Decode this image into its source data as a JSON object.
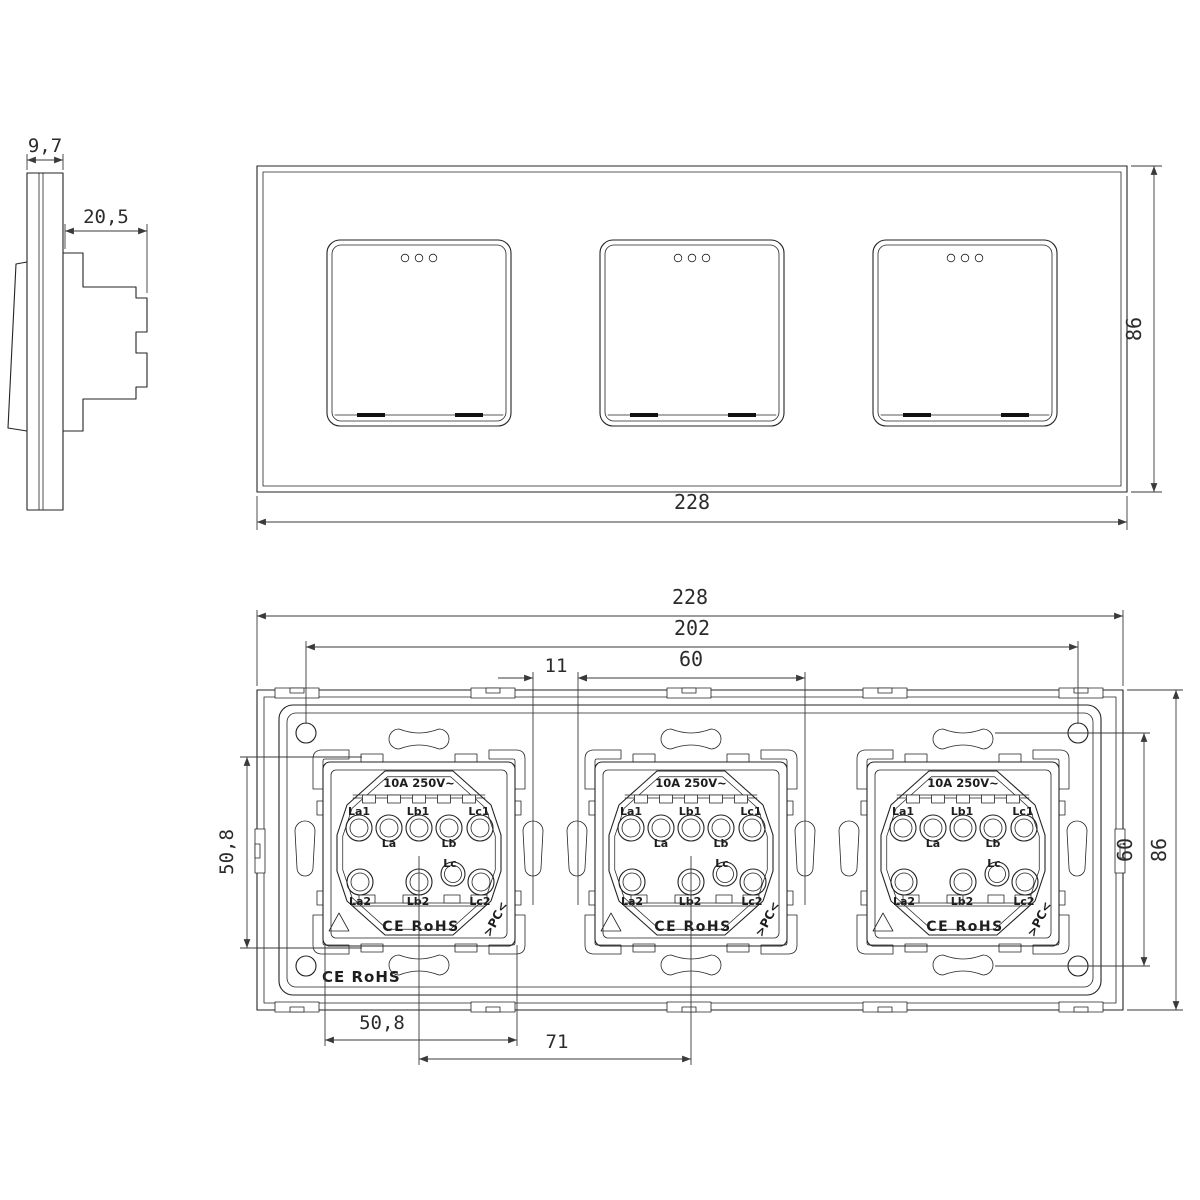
{
  "side_view": {
    "front_thickness_mm": "9,7",
    "mount_depth_mm": "20,5"
  },
  "front_view": {
    "width_mm": "228",
    "height_mm": "86"
  },
  "back_view": {
    "width_mm": "228",
    "screw_hole_span_mm": "202",
    "module_width_mm": "60",
    "module_gap_mm": "11",
    "slot_span_vertical_mm": "50,8",
    "screw_span_vertical_mm": "60",
    "height_mm": "86",
    "slot_span_horizontal_mm": "50,8",
    "module_center_distance_mm": "71",
    "frame_marking": "CE RoHS"
  },
  "module": {
    "rating": "10A 250V~",
    "terminal_la1": "La1",
    "terminal_la": "La",
    "terminal_lb1": "Lb1",
    "terminal_lb": "Lb",
    "terminal_lc1": "Lc1",
    "terminal_la2": "La2",
    "terminal_lb2": "Lb2",
    "terminal_lc": "Lc",
    "terminal_lc2": "Lc2",
    "certification": "CE RoHS",
    "material_marking": ">PC<"
  }
}
